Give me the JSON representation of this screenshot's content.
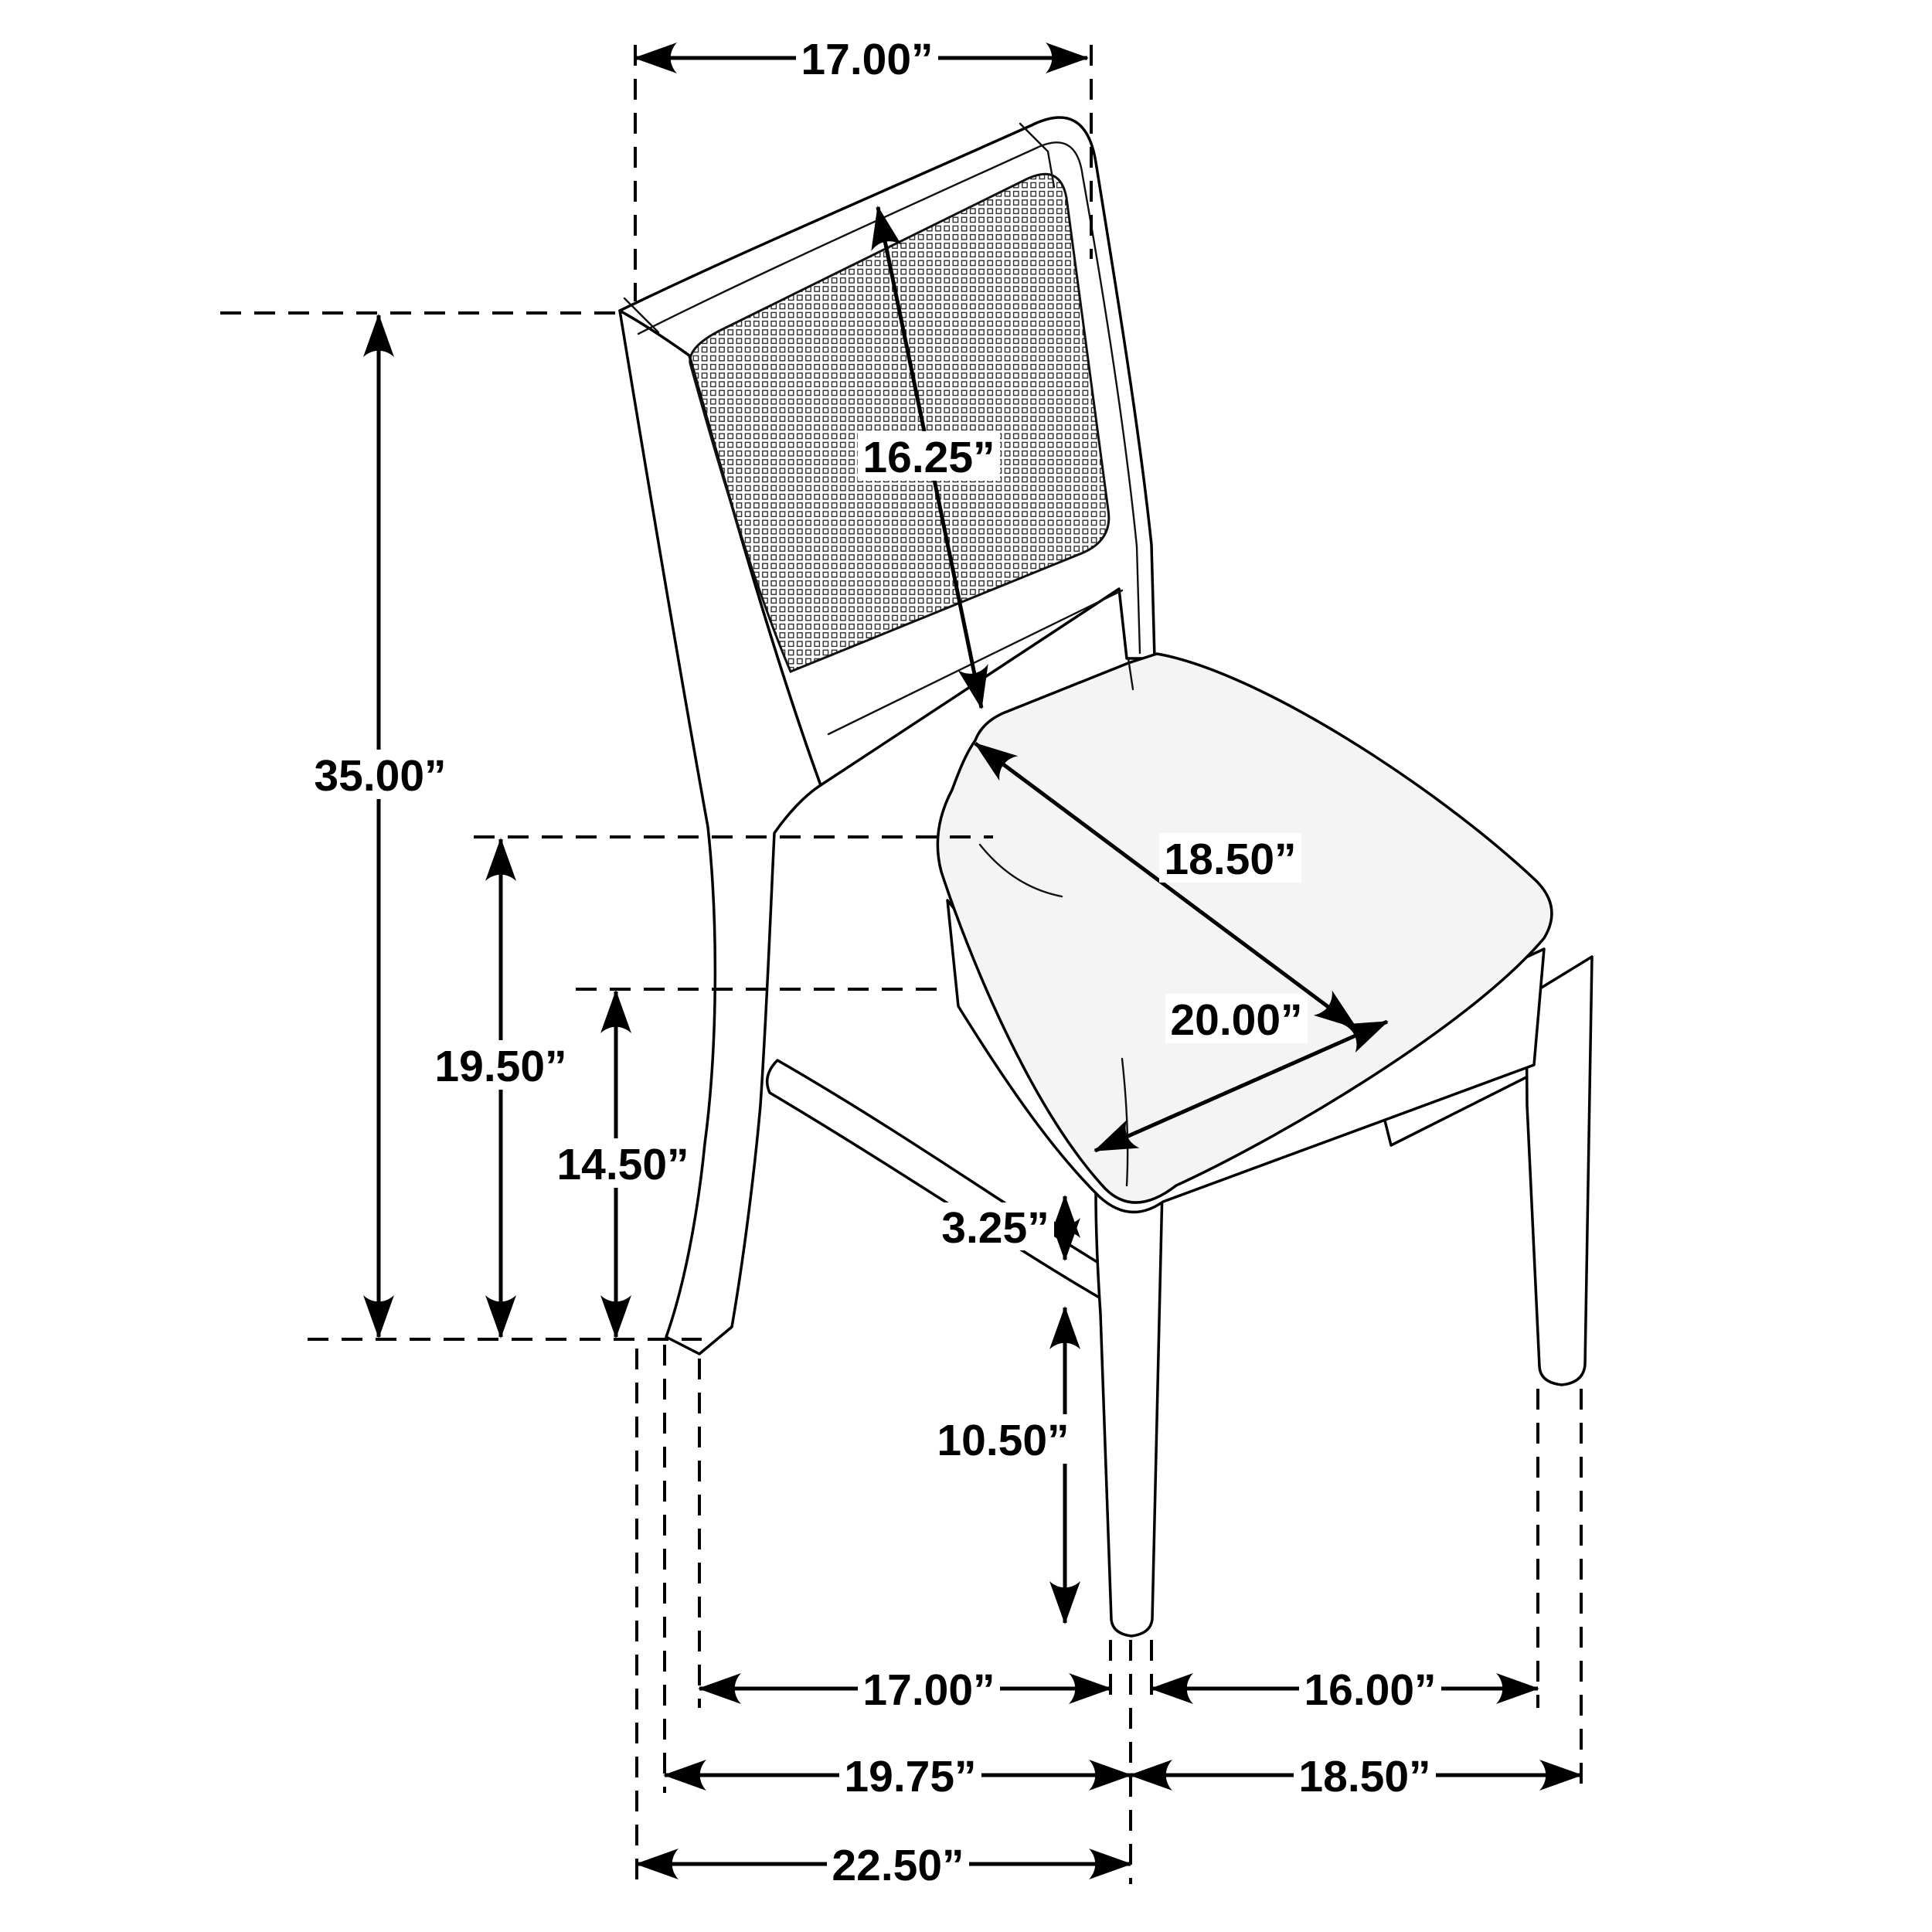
{
  "diagram": {
    "type": "furniture-dimension-drawing",
    "subject": "side chair with cane back panel and upholstered seat",
    "unit": "inches",
    "line_color": "#000000",
    "background_color": "#ffffff",
    "dimensions": {
      "back_width": "17.00”",
      "back_panel_diagonal": "16.25”",
      "overall_height": "35.00”",
      "seat_height": "19.50”",
      "apron_clearance_height": "14.50”",
      "seat_depth": "18.50”",
      "seat_width": "20.00”",
      "apron_to_stretcher_gap": "3.25”",
      "stretcher_floor_height": "10.50”",
      "front_leg_to_back_leg_span": "17.00”",
      "front_leg_spacing": "16.00”",
      "footprint_depth_left": "19.75”",
      "footprint_width_right": "18.50”",
      "overall_depth": "22.50”"
    }
  }
}
